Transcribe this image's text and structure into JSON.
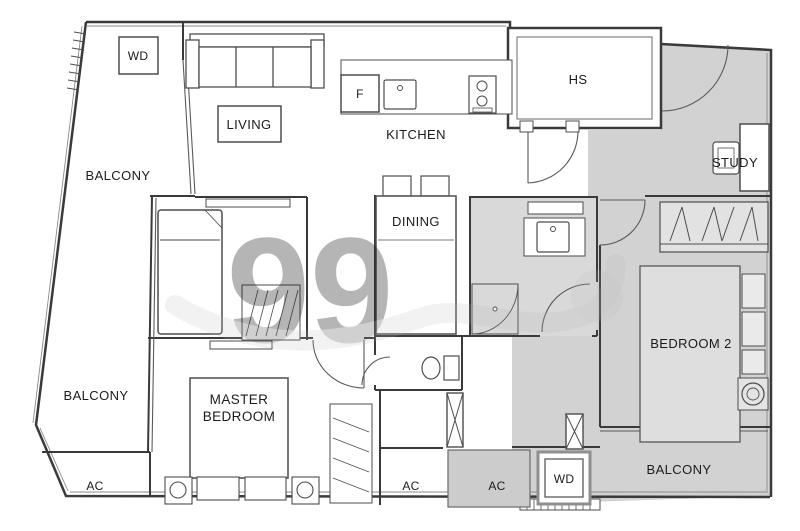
{
  "watermark": {
    "text": "99"
  },
  "colors": {
    "wall": "#3a3a3a",
    "furniture_line": "#4d4d4d",
    "text": "#1b1b1b",
    "gray_zone": "#d2d2d2",
    "bathroom_floor": "#d9d9d9",
    "bed_fill": "#dedede",
    "wardrobe_fill": "#e2e2e2",
    "ac_box_fill": "#cccccc",
    "watermark": "#b5b5b5"
  },
  "rooms": {
    "balcony_top_left": {
      "label": "BALCONY"
    },
    "living": {
      "label": "LIVING"
    },
    "kitchen": {
      "label": "KITCHEN"
    },
    "dining": {
      "label": "DINING"
    },
    "household_shelter": {
      "label": "HS"
    },
    "study": {
      "label": "STUDY"
    },
    "bedroom_2": {
      "label": "BEDROOM 2"
    },
    "master_bedroom": {
      "label": "MASTER BEDROOM",
      "lines": [
        "MASTER",
        "BEDROOM"
      ]
    },
    "balcony_bottom_left": {
      "label": "BALCONY"
    },
    "balcony_bottom_right": {
      "label": "BALCONY"
    }
  },
  "fixtures": {
    "washer_dryer_top_left": {
      "label": "WD"
    },
    "fridge": {
      "label": "F"
    },
    "ac_ledge_bottom_left": {
      "label": "AC"
    },
    "ac_ledge_bottom_middle": {
      "label": "AC"
    },
    "ac_ledge_bottom_right": {
      "label": "AC"
    },
    "washer_dryer_bottom_right": {
      "label": "WD"
    }
  }
}
